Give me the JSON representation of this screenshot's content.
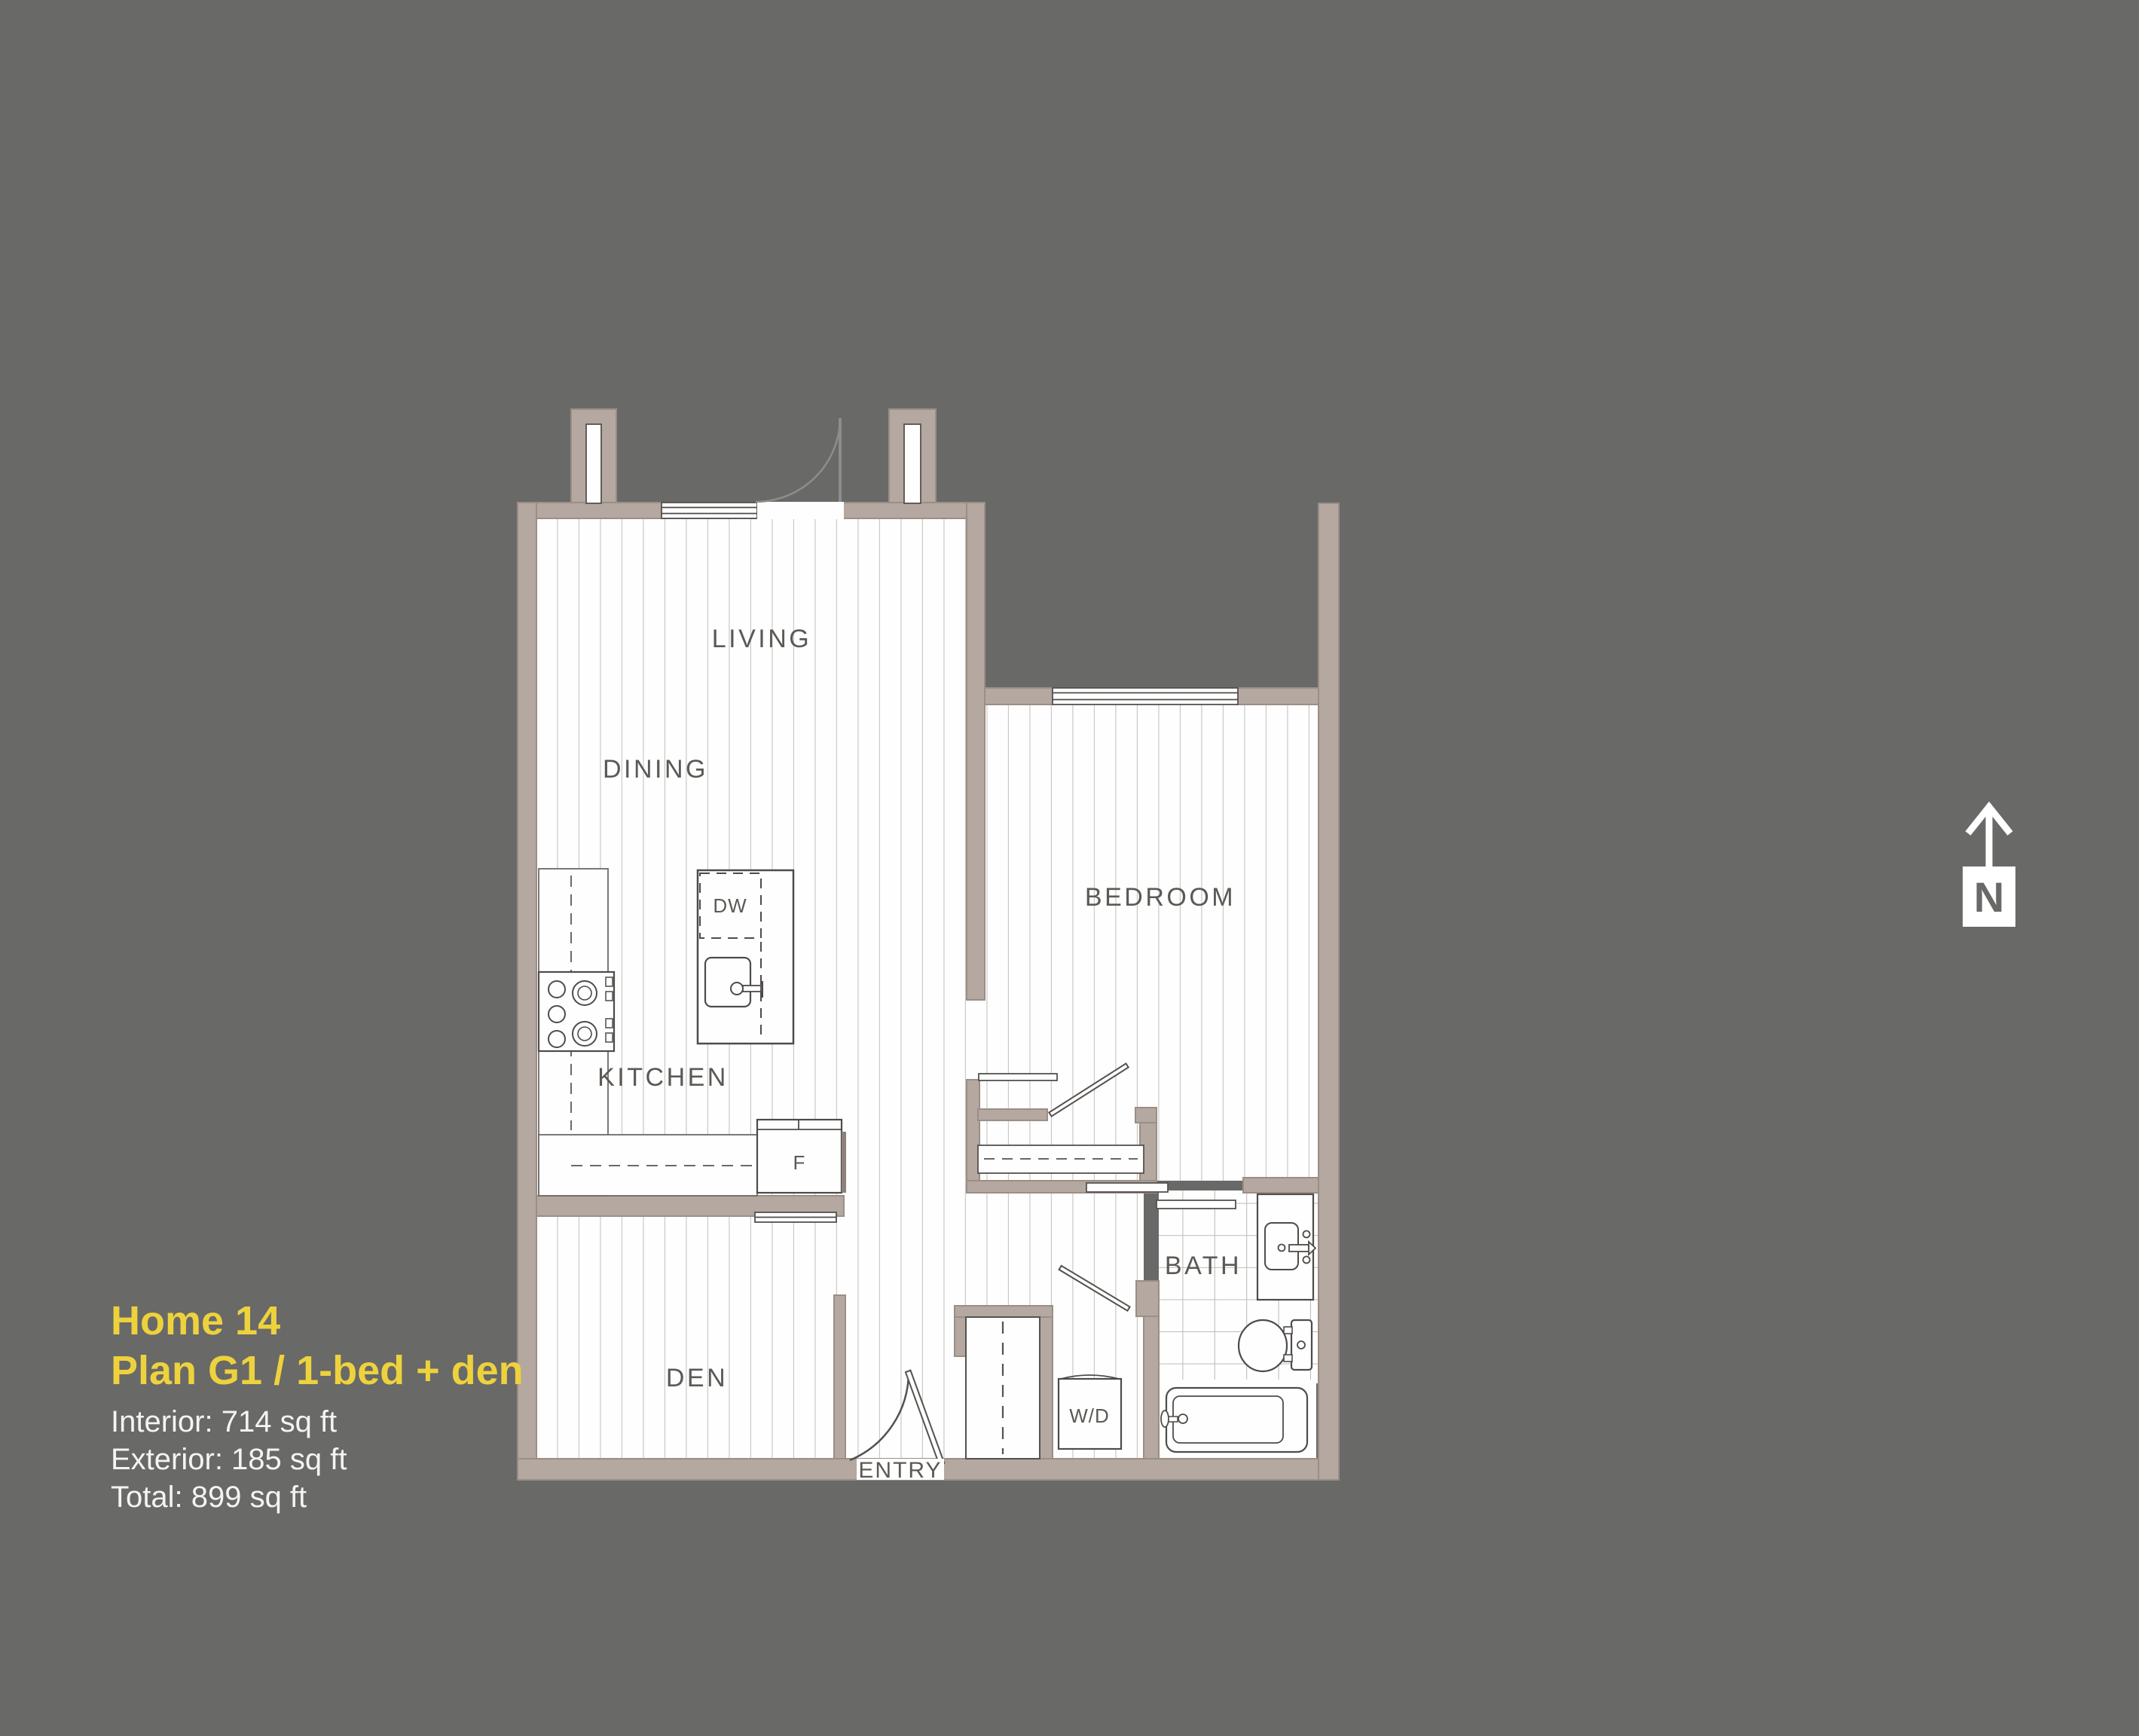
{
  "page": {
    "background_color": "#696968"
  },
  "title_block": {
    "home_name": "Home 14",
    "plan_name": "Plan G1 / 1-bed + den",
    "interior_area": "Interior: 714 sq ft",
    "exterior_area": "Exterior: 185 sq ft",
    "total_area": "Total: 899 sq ft",
    "accent_color": "#edd23d",
    "text_color": "#f4f4f1"
  },
  "compass": {
    "label": "N",
    "direction": "north-up"
  },
  "floorplan": {
    "wall_color": "#b4a8a1",
    "floor_color": "#fefefe",
    "plank_line_color": "#cbc7c4",
    "tile_line_color": "#bfbbb8",
    "label_color": "#5c5955",
    "rooms": [
      {
        "label": "LIVING"
      },
      {
        "label": "DINING"
      },
      {
        "label": "KITCHEN"
      },
      {
        "label": "BEDROOM"
      },
      {
        "label": "DEN"
      },
      {
        "label": "BATH"
      },
      {
        "label": "ENTRY"
      }
    ],
    "appliances": [
      {
        "label": "DW",
        "meaning": "dishwasher"
      },
      {
        "label": "F",
        "meaning": "fridge"
      },
      {
        "label": "W/D",
        "meaning": "washer-dryer"
      }
    ]
  }
}
